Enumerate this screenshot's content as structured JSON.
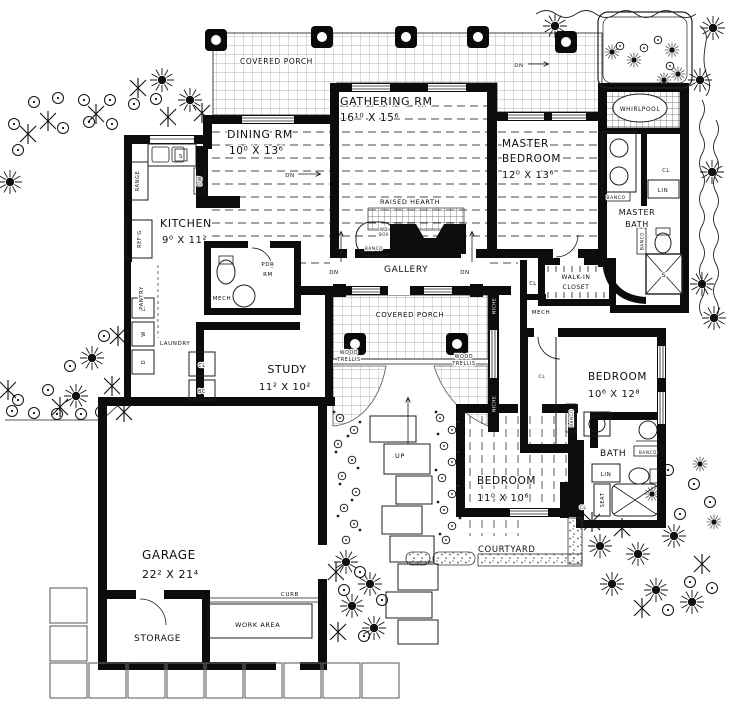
{
  "rooms": {
    "covered_porch_top": {
      "name": "COVERED PORCH"
    },
    "gathering": {
      "name": "GATHERING RM",
      "dims": "16¹⁰ X 15⁶"
    },
    "dining": {
      "name": "DINING RM",
      "dims": "10⁰ X 13⁶"
    },
    "master_bedroom": {
      "line1": "MASTER",
      "line2": "BEDROOM",
      "dims": "12⁰ X 13⁶"
    },
    "kitchen": {
      "name": "KITCHEN",
      "dims": "9⁰ X 11²"
    },
    "master_bath": {
      "line1": "MASTER",
      "line2": "BATH"
    },
    "gallery": {
      "name": "GALLERY"
    },
    "walk_in_closet": {
      "line1": "WALK-IN",
      "line2": "CLOSET"
    },
    "covered_porch_mid": {
      "name": "COVERED PORCH"
    },
    "study": {
      "name": "STUDY",
      "dims": "11² X 10²"
    },
    "bedroom_right": {
      "name": "BEDROOM",
      "dims": "10⁶ X 12⁸"
    },
    "bedroom_bottom": {
      "name": "BEDROOM",
      "dims": "11⁰ X 10⁶"
    },
    "bath": {
      "name": "BATH"
    },
    "garage": {
      "name": "GARAGE",
      "dims": "22² X 21⁴"
    },
    "storage": {
      "name": "STORAGE"
    },
    "work_area": {
      "name": "WORK AREA"
    },
    "courtyard": {
      "name": "COURTYARD"
    },
    "laundry": {
      "name": "LAUNDRY"
    },
    "pantry": {
      "name": "PANTRY"
    },
    "powder_room": {
      "line1": "PDR",
      "line2": "RM"
    }
  },
  "annotations": {
    "raised_hearth": "RAISED HEARTH",
    "whirlpool": "WHIRLPOOL",
    "banco": "BANCO",
    "wood_trellis_line1": "WOOD",
    "wood_trellis_line2": "TRELLIS",
    "wd_box_line1": "WD",
    "wd_box_line2": "BOX",
    "niche": "NICHE",
    "curb": "CURB",
    "range": "RANGE",
    "refrigerator": "REF'G",
    "mech": "MECH",
    "closet": "CL",
    "linen": "LIN",
    "bookcase": "BC",
    "seat": "SEAT",
    "down": "DN",
    "up": "UP",
    "sink": "S",
    "dishwasher": "DW",
    "dryer": "D",
    "washer": "W",
    "laundry_tray": "LT"
  }
}
